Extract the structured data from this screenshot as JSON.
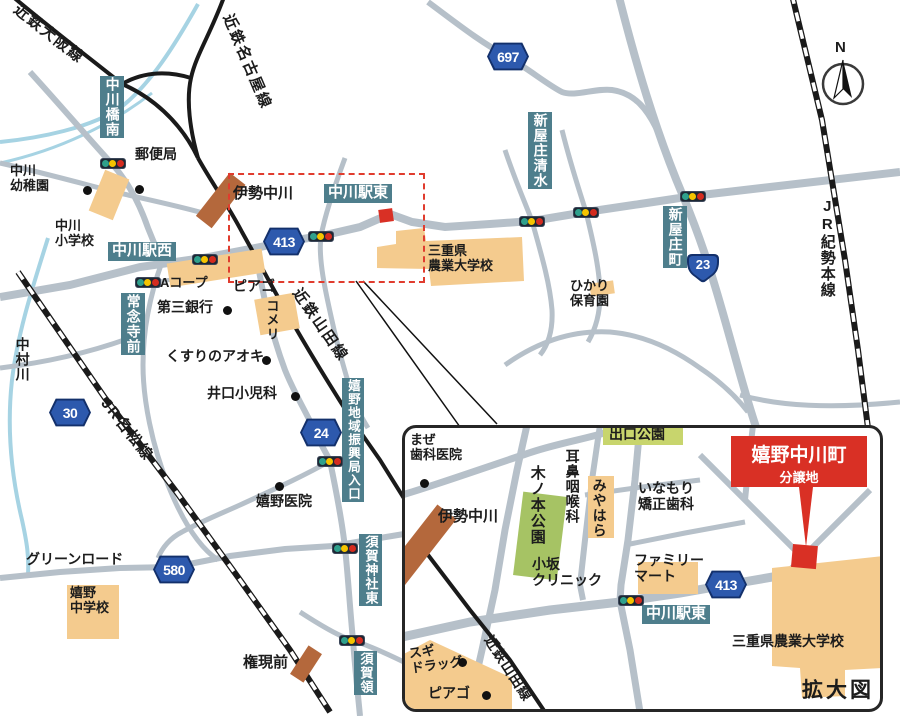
{
  "compass": {
    "north": "N"
  },
  "badges": {
    "r697": "697",
    "r413": "413",
    "r23": "23",
    "r30": "30",
    "r24": "24",
    "r580": "580",
    "r413_inset": "413"
  },
  "rail_lines": {
    "kintetsu_osaka": "近鉄大阪線",
    "kintetsu_nagoya": "近鉄名古屋線",
    "kintetsu_yamada": "近鉄山田線",
    "jr_meisho": "JR名松線",
    "jr_kisei": "JR紀勢本線",
    "kintetsu_yamada_inset": "近鉄山田線"
  },
  "signs_teal": {
    "nakagawabashi_minami": "中川橋南",
    "nakagawa_eki_nishi": "中川駅西",
    "nakagawa_eki_higashi": "中川駅東",
    "jonenji_mae": "常念寺前",
    "shinyasho_shimizu": "新屋庄清水",
    "shinyasho_cho": "新屋庄町",
    "ureshino_chiiki_shinkokyoku_iriguchi": "嬉野地域振興局入口",
    "suga_jinja_higashi": "須賀神社東",
    "suga_ryo": "須賀領",
    "nakagawa_eki_higashi_inset": "中川駅東"
  },
  "pois_main": {
    "yubinkyoku": "郵便局",
    "nakagawa_yochien": "中川\n幼稚園",
    "nakagawa_shogakko": "中川\n小学校",
    "ise_nakagawa": "伊勢中川",
    "a_coop": "Aコープ",
    "daisan_ginko": "第三銀行",
    "piago": "ピアゴ",
    "komeri": "コメリ",
    "kusuri_no_aoki": "くすりのアオキ",
    "iguchi_shonika": "井口小児科",
    "mie_nogyo_daigakko": "三重県\n農業大学校",
    "hikari_hoikuen": "ひかり\n保育園",
    "nakamura_gawa": "中村川",
    "green_road": "グリーンロード",
    "ureshino_chugakko": "嬉野\n中学校",
    "ureshino_iin": "嬉野医院",
    "gongen_mae": "権現前"
  },
  "pois_inset": {
    "maze_shika": "まぜ\n歯科医院",
    "ise_nakagawa": "伊勢中川",
    "kinomoto_koen": "木ノ本公園",
    "jibi_inkoka": "耳鼻咽喉科",
    "miyahara": "みやはら",
    "deguchi_koen": "出口公園",
    "inamori_kyosei_shika": "いなもり\n矯正歯科",
    "family_mart": "ファミリー\nマート",
    "kosaka_clinic": "小坂\nクリニック",
    "mie_nogyo_daigakko": "三重県農業大学校",
    "sugi_drug": "スギ\nドラッグ",
    "piago": "ピアゴ",
    "kakudaizu": "拡大図"
  },
  "site": {
    "line1": "嬉野中川町",
    "line2": "分譲地"
  },
  "colors": {
    "road": "#b6c0c9",
    "rail": "#1a1a1a",
    "river": "#a6d3e3",
    "building": "#f4cb8e",
    "station": "#b4683c",
    "park": "#a6c364",
    "label_teal": "#4e7e8c",
    "site_red": "#d93025",
    "badge_blue": "#2d59ad"
  }
}
